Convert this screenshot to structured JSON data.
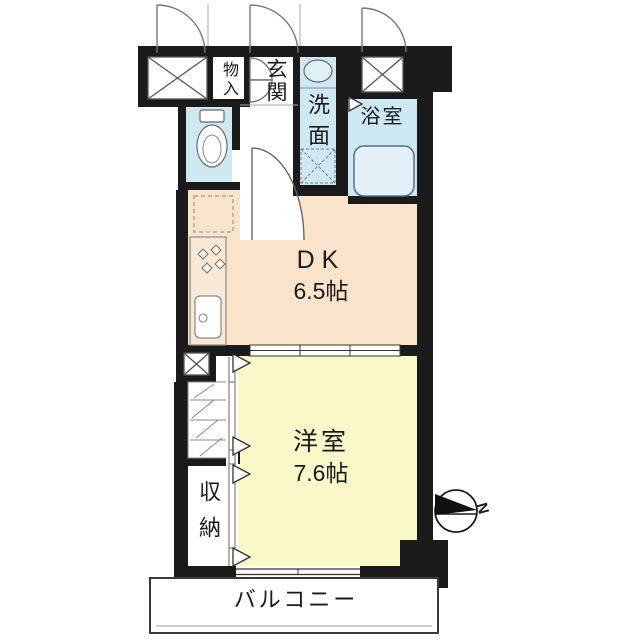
{
  "floorplan": {
    "rooms": [
      {
        "id": "storage-top",
        "label": "物入"
      },
      {
        "id": "entrance",
        "label": "玄関"
      },
      {
        "id": "washroom",
        "label": "洗面"
      },
      {
        "id": "bathroom",
        "label": "浴室"
      },
      {
        "id": "dining-kitchen",
        "label": "DK",
        "size": "6.5帖"
      },
      {
        "id": "western-room",
        "label": "洋室",
        "size": "7.6帖"
      },
      {
        "id": "closet",
        "label": "収納"
      },
      {
        "id": "balcony",
        "label": "バルコニー"
      }
    ],
    "compass": {
      "north_label": "N"
    },
    "colors": {
      "wall": "#1a1a1a",
      "wet_area": "#cfe9f2",
      "dining_kitchen": "#fae3cb",
      "western_room": "#f9f8c8",
      "floor_white": "#ffffff"
    }
  }
}
